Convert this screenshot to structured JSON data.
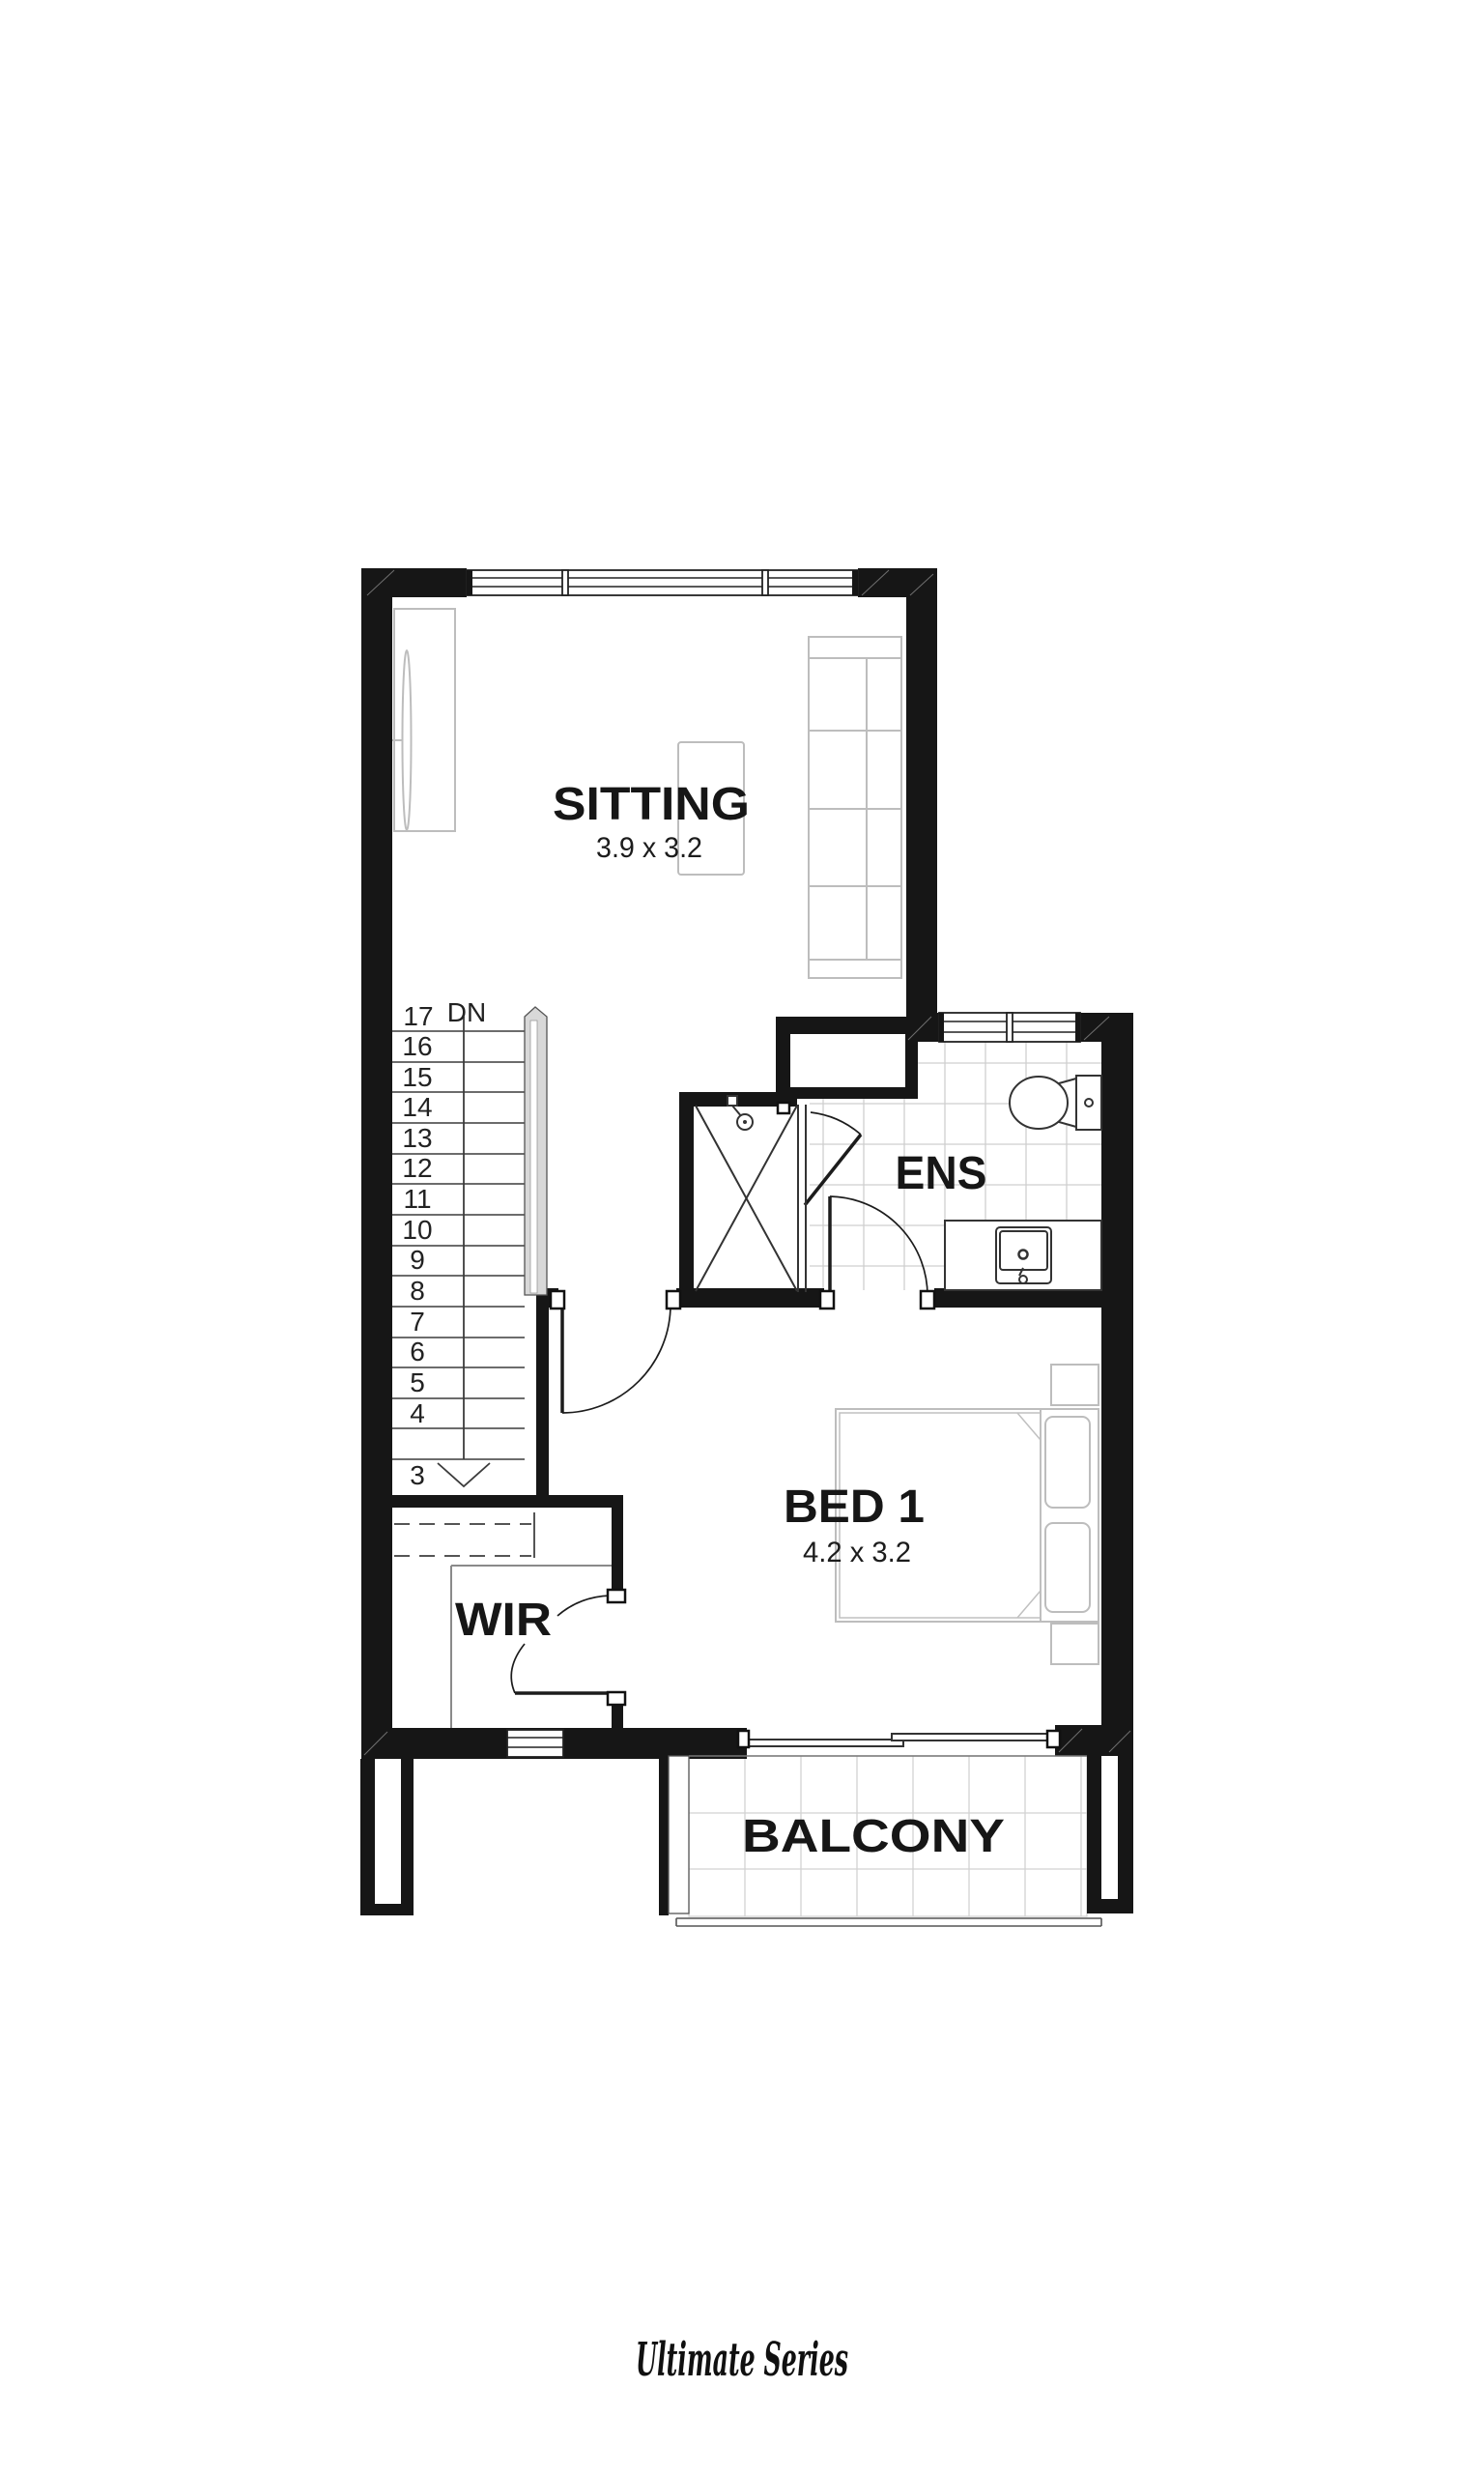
{
  "rooms": {
    "sitting": {
      "name": "SITTING",
      "dims": "3.9 x 3.2"
    },
    "ens": {
      "name": "ENS"
    },
    "bed1": {
      "name": "BED 1",
      "dims": "4.2 x 3.2"
    },
    "wir": {
      "name": "WIR"
    },
    "balcony": {
      "name": "BALCONY"
    }
  },
  "stairs": {
    "top_step": "17",
    "down_label": "DN",
    "steps": [
      "16",
      "15",
      "14",
      "13",
      "12",
      "11",
      "10",
      "9",
      "8",
      "7",
      "6",
      "5",
      "4"
    ],
    "bottom_step": "3"
  },
  "footer": {
    "brand_script": "Ultimate Series"
  },
  "colors": {
    "wall": "#161616",
    "label": "#161616",
    "fixture_line": "#333333",
    "furniture_line": "#bdbdbd",
    "tile_line": "#cfcfcf",
    "background": "#ffffff"
  }
}
